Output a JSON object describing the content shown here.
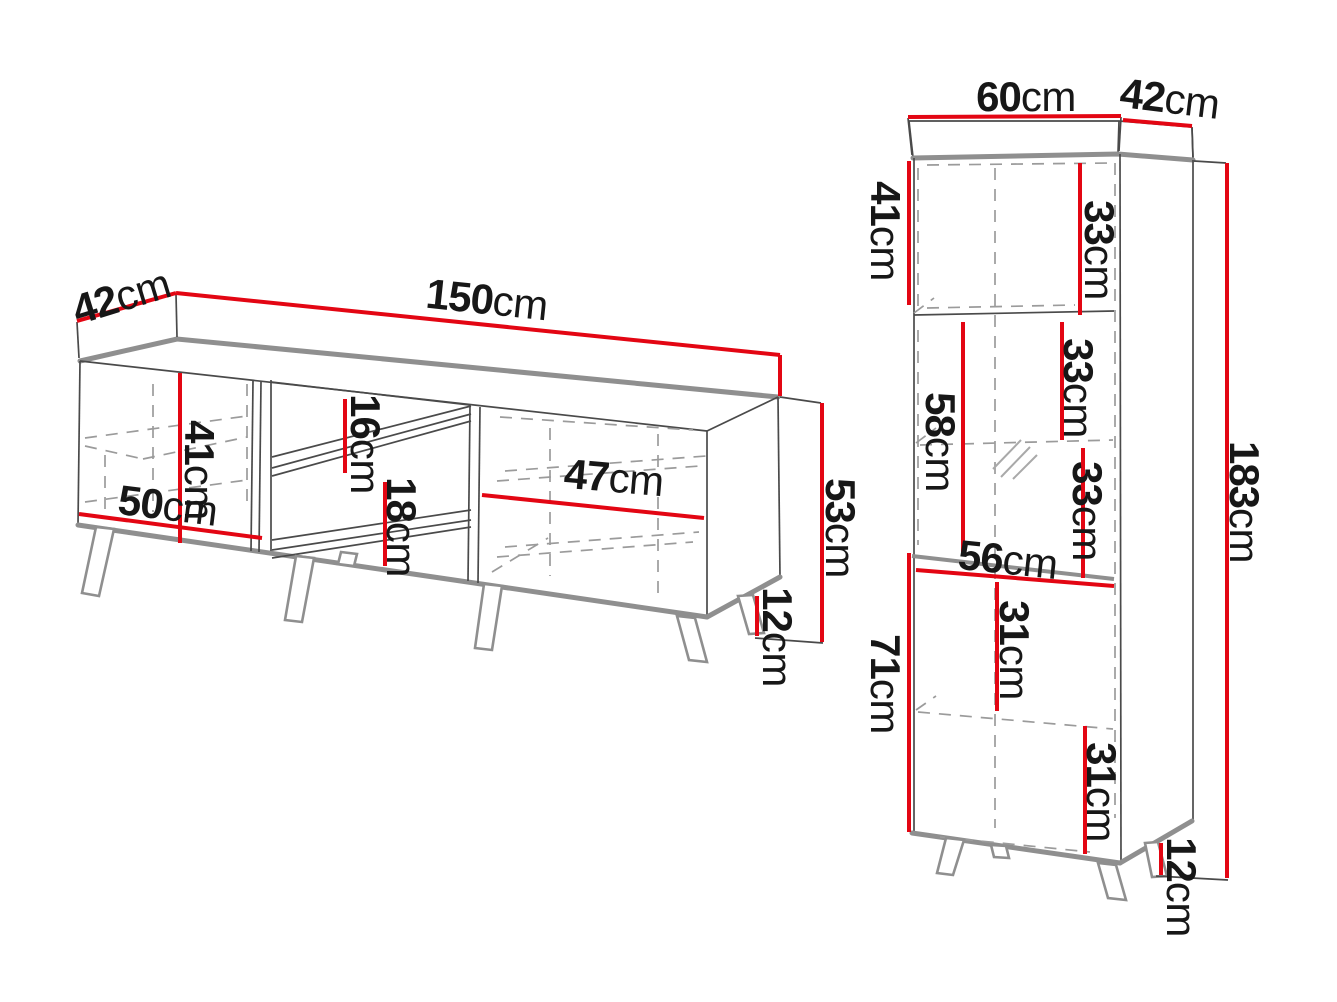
{
  "palette": {
    "background": "#ffffff",
    "dimension_red": "#e30613",
    "edge_thick_gray": "#8f8f8f",
    "line_dark": "#4a4a4a",
    "dashed_gray": "#9b9b9b",
    "label_color": "#171717"
  },
  "tv_stand": {
    "name": "TV stand dimension drawing",
    "labels": {
      "depth": {
        "value": "42",
        "unit": "cm"
      },
      "width": {
        "value": "150",
        "unit": "cm"
      },
      "left_door_height": {
        "value": "41",
        "unit": "cm"
      },
      "left_door_width": {
        "value": "50",
        "unit": "cm"
      },
      "upper_shelf_gap": {
        "value": "16",
        "unit": "cm"
      },
      "lower_shelf_gap": {
        "value": "18",
        "unit": "cm"
      },
      "right_door_width": {
        "value": "47",
        "unit": "cm"
      },
      "body_height": {
        "value": "53",
        "unit": "cm"
      },
      "leg_height": {
        "value": "12",
        "unit": "cm"
      }
    }
  },
  "tall_cabinet": {
    "name": "Tall cabinet dimension drawing",
    "labels": {
      "width": {
        "value": "60",
        "unit": "cm"
      },
      "depth": {
        "value": "42",
        "unit": "cm"
      },
      "top_door_height": {
        "value": "41",
        "unit": "cm"
      },
      "top_compartment": {
        "value": "33",
        "unit": "cm"
      },
      "glass_section_height": {
        "value": "58",
        "unit": "cm"
      },
      "middle_compartment_upper": {
        "value": "33",
        "unit": "cm"
      },
      "middle_compartment_lower": {
        "value": "33",
        "unit": "cm"
      },
      "shelf_width": {
        "value": "56",
        "unit": "cm"
      },
      "lower_compartment_upper": {
        "value": "31",
        "unit": "cm"
      },
      "bottom_door_height": {
        "value": "71",
        "unit": "cm"
      },
      "lower_compartment_lower": {
        "value": "31",
        "unit": "cm"
      },
      "total_height": {
        "value": "183",
        "unit": "cm"
      },
      "leg_height": {
        "value": "12",
        "unit": "cm"
      }
    }
  }
}
